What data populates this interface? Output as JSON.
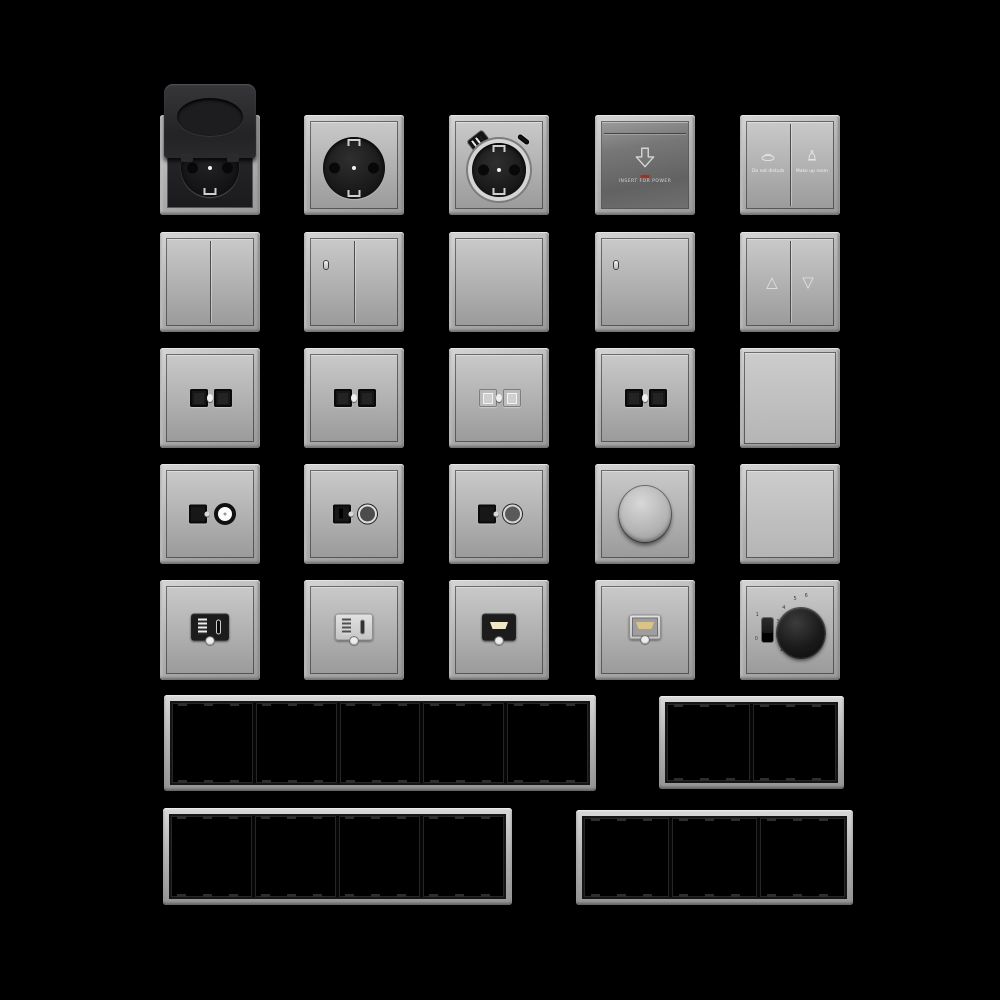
{
  "canvas": {
    "width": 1000,
    "height": 1000,
    "background": "#000000"
  },
  "palette": {
    "background": "#000000",
    "frame_grey": "#b9b9b9",
    "face_light": "#c9c9c9",
    "face_dark": "#9b9b9b",
    "module_black": "#1c1c1c",
    "keycard_face": "#6f6f6f",
    "led_red": "#93362c",
    "hdmi_slot": "#efe6c8",
    "hdmi_gold": "#d9c387"
  },
  "catalog": {
    "rows": [
      {
        "items": [
          "schuko-socket-with-hinged-lid",
          "schuko-socket",
          "schuko-socket-usb-a-c",
          "key-card-power-switch",
          "hotel-service-double-switch"
        ]
      },
      {
        "items": [
          "double-rocker-switch",
          "double-rocker-switch-indicator",
          "single-rocker-switch",
          "single-rocker-switch-indicator",
          "shutter-rocker-switch"
        ]
      },
      {
        "items": [
          "dual-data-outlet-black",
          "dual-data-outlet-black-2",
          "dual-data-outlet-shuttered",
          "dual-data-outlet-black-3",
          "blank-rocker-plate"
        ]
      },
      {
        "items": [
          "tv-sat-outlet-white-core",
          "tv-sat-outlet-dark-core",
          "tv-sat-outlet-dark-core-2",
          "rotary-dimmer",
          "blank-cover-plate"
        ]
      },
      {
        "items": [
          "usb-a-c-charger-black",
          "usb-a-c-charger-grey",
          "hdmi-outlet-black",
          "hdmi-outlet-grey",
          "thermostat-dial"
        ]
      }
    ],
    "frames": [
      {
        "name": "cover-frame-5-gang",
        "gangs": 5
      },
      {
        "name": "cover-frame-2-gang",
        "gangs": 2
      },
      {
        "name": "cover-frame-4-gang",
        "gangs": 4
      },
      {
        "name": "cover-frame-3-gang",
        "gangs": 3
      }
    ]
  },
  "keycard": {
    "icon": "arrow-down-icon",
    "led_color": "#93362c",
    "label": "INSERT FOR POWER"
  },
  "hotel_switch": {
    "left": {
      "icon": "do-not-disturb-icon",
      "label": "Do not disturb"
    },
    "right": {
      "icon": "make-up-room-icon",
      "label": "Make up room"
    }
  },
  "shutter_switch": {
    "up_glyph": "△",
    "down_glyph": "▽"
  },
  "thermostat": {
    "switch_on": "1",
    "switch_off": "0",
    "dial_numbers": [
      "1",
      "2",
      "3",
      "4",
      "5",
      "6"
    ]
  }
}
